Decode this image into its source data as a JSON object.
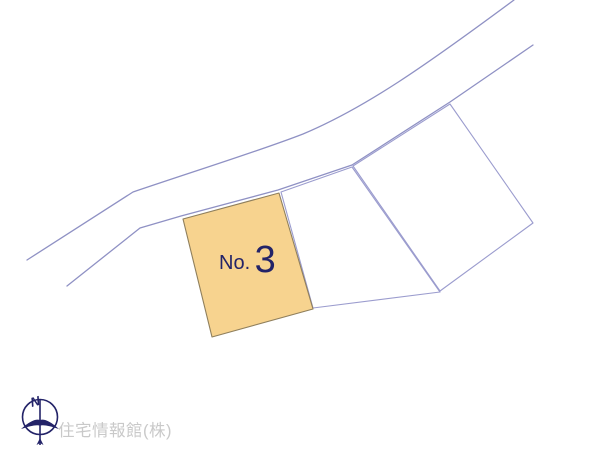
{
  "colors": {
    "background": "#ffffff",
    "road_line": "#8f91c4",
    "boundary_line": "#9b9cce",
    "lot_fill": "#f7d38f",
    "lot_border": "#8f7f5c",
    "navy": "#232368",
    "watermark_gray": "#c9c9c9"
  },
  "plot_map": {
    "highlighted_lot": {
      "label_prefix": "No.",
      "label_number": "3"
    },
    "compass": {
      "north_label": "N"
    },
    "watermark": {
      "text": "住宅情報館(株)"
    }
  }
}
